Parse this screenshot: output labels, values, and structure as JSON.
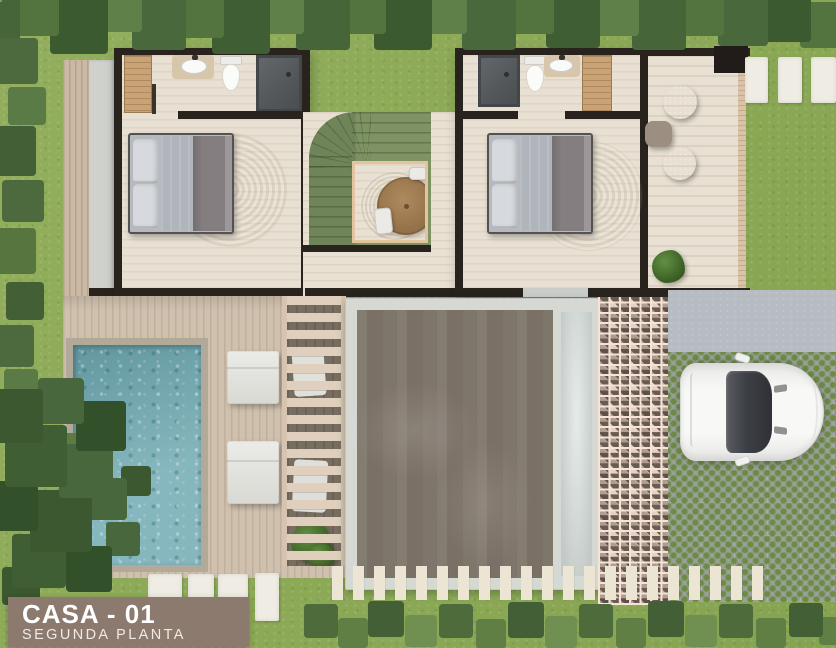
{
  "banner": {
    "title": "CASA - 01",
    "subtitle": "SEGUNDA PLANTA"
  },
  "theme": {
    "grass": "#8caa54",
    "wall": "#29231e",
    "floor": "#e8e0d2",
    "deck": "#d0c1af",
    "pool_water": "#7fb2ba",
    "pool_border": "#b2a999",
    "stairs_green": "#7e9162",
    "glass_roof": "#7a7065",
    "lattice": "#ead0c0",
    "paver": "#9aa09c",
    "concrete_pad": "#b7bcc3",
    "banner_bg": "#8c7a6f",
    "car_body": "#f4f4f2",
    "wood": "#c9a376"
  }
}
